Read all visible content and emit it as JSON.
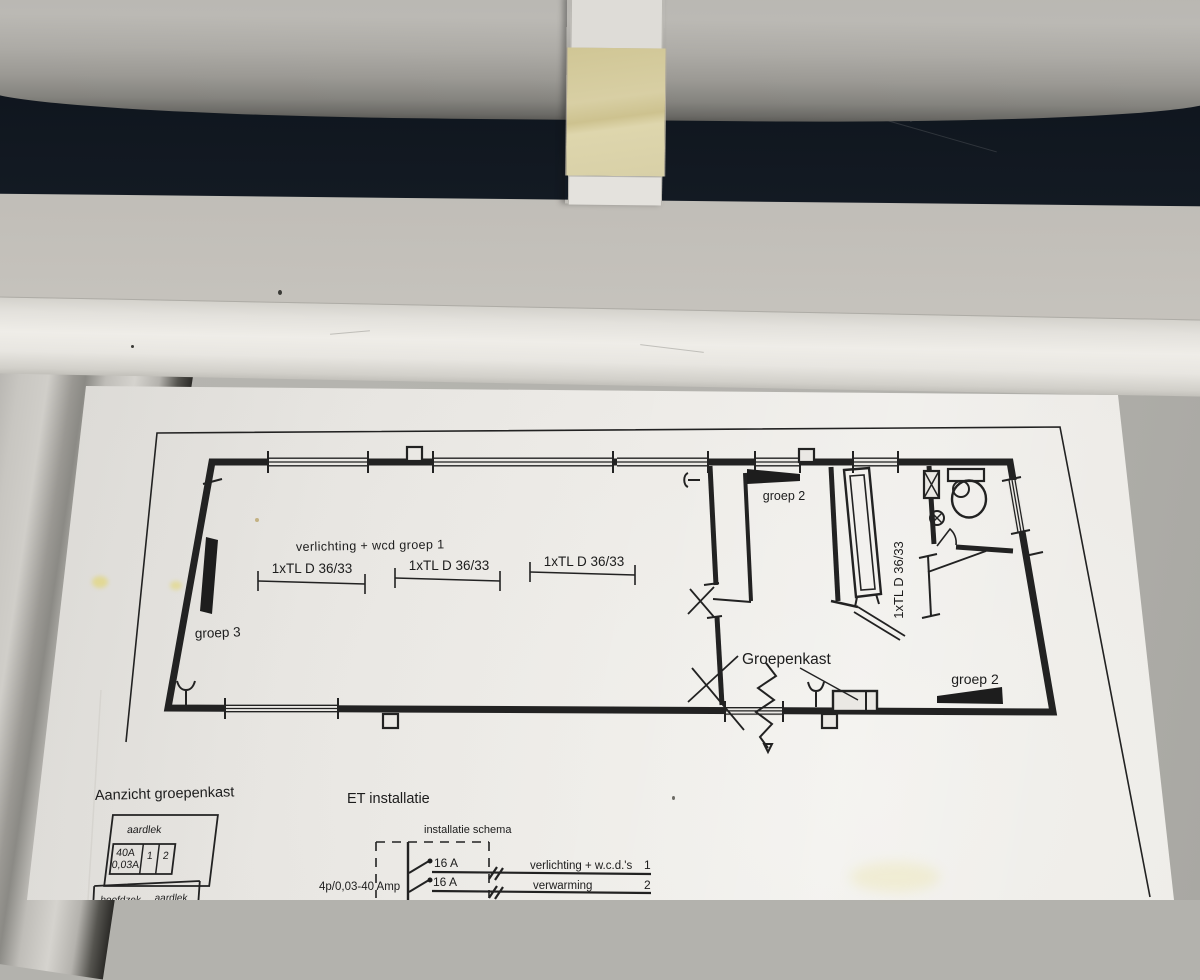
{
  "floor_plan": {
    "area_label": "verlichting + wcd groep 1",
    "tl_labels": [
      "1xTL D 36/33",
      "1xTL D 36/33",
      "1xTL D 36/33"
    ],
    "tl_label_vertical": "1xTL D 36/33",
    "groep3_label": "groep 3",
    "groep2_top_label": "groep 2",
    "groep2_right_label": "groep 2",
    "groepenkast_label": "Groepenkast"
  },
  "panel_view": {
    "title": "Aanzicht groepenkast",
    "aardlek_label": "aardlek",
    "rating_amps": "40A",
    "rating_trip": "0,03A",
    "group_1": "1",
    "group_2": "2",
    "partial_left": "hoofdzek",
    "partial_right": "aardlek"
  },
  "et_installation": {
    "title": "ET installatie",
    "schema_title": "installatie schema",
    "main_switch": "4p/0,03-40 Amp",
    "circuit1": {
      "rating": "16 A",
      "label": "verlichting + w.c.d.'s",
      "number": "1"
    },
    "circuit2": {
      "rating": "16 A",
      "label": "verwarming",
      "number": "2"
    }
  },
  "colors": {
    "background_dark": "#10161f",
    "pipe_gray": "#b2b0ab",
    "wall_gray": "#c7c4be",
    "molding_white": "#e9e7e2",
    "paper_white": "#edebe7",
    "bracket_cream": "#d7cea3",
    "ink": "#1d1d1d",
    "stain_yellow": "#e3d45e"
  }
}
